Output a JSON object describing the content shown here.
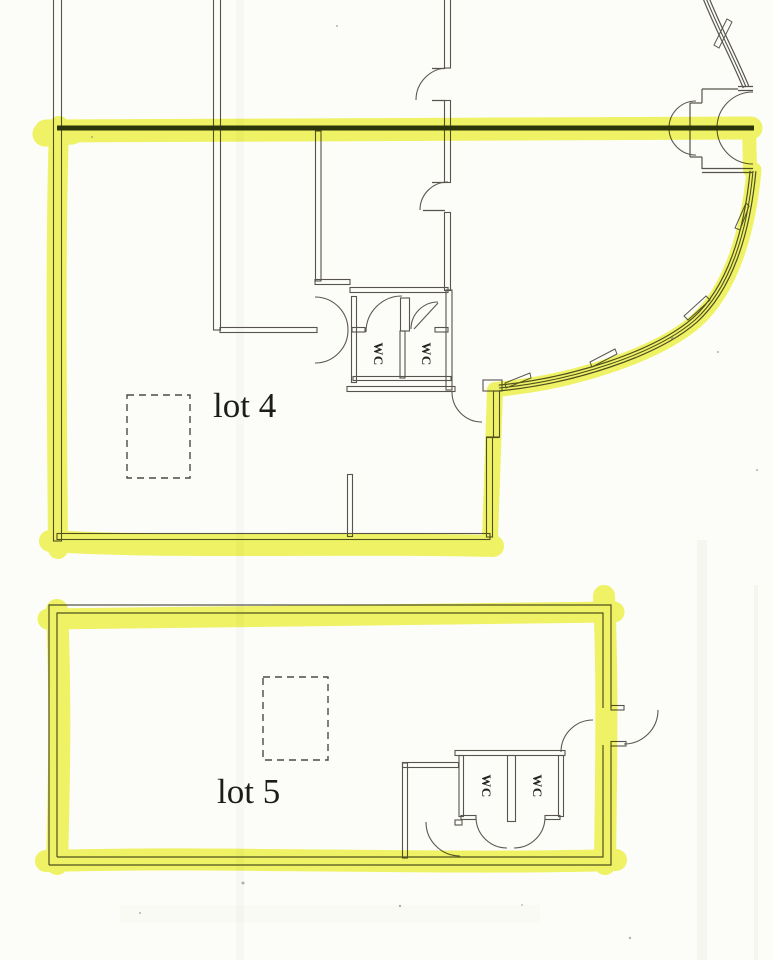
{
  "page": {
    "title": "Scanned floor plan with highlighted lettable areas",
    "document_type": "architectural floor plan scan"
  },
  "labels": {
    "lot4": "lot 4",
    "lot5": "lot 5",
    "wc": "WC"
  },
  "colors": {
    "highlighter_yellow": "#f0f452",
    "wall_line": "#56544c",
    "separation_line": "#2e3614",
    "paper": "#fcfcf8"
  }
}
